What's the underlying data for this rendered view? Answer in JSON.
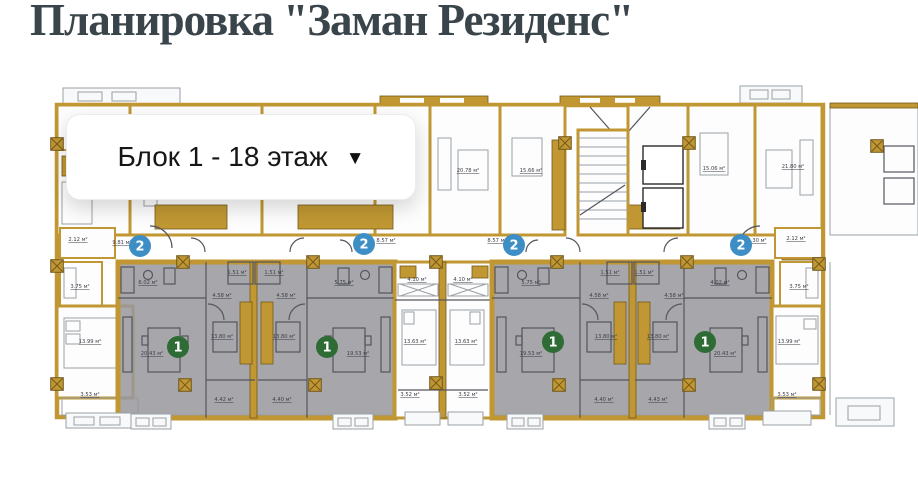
{
  "header": {
    "title": "Планировка \"Заман Резиденс\""
  },
  "selector": {
    "value": "Блок 1 - 18 этаж",
    "icon": "chevron-down"
  },
  "colors": {
    "wall": "#c09733",
    "wall_dark": "#73591b",
    "unit_highlight": "#96969c",
    "badge_green": "#2e6b35",
    "badge_blue": "#3e8ec6",
    "title": "#3a444b",
    "line": "#9aa1a6",
    "dark_line": "#55555e"
  },
  "plan": {
    "area_unit": "м²",
    "badges": [
      {
        "name": "rooms-2-badge",
        "label": "2",
        "x": 140,
        "y": 246,
        "color": "#3e8ec6"
      },
      {
        "name": "rooms-2-badge",
        "label": "2",
        "x": 364,
        "y": 244,
        "color": "#3e8ec6"
      },
      {
        "name": "rooms-2-badge",
        "label": "2",
        "x": 514,
        "y": 245,
        "color": "#3e8ec6"
      },
      {
        "name": "rooms-2-badge",
        "label": "2",
        "x": 741,
        "y": 245,
        "color": "#3e8ec6"
      },
      {
        "name": "rooms-1-badge",
        "label": "1",
        "x": 178,
        "y": 347,
        "color": "#2e6b35"
      },
      {
        "name": "rooms-1-badge",
        "label": "1",
        "x": 327,
        "y": 347,
        "color": "#2e6b35"
      },
      {
        "name": "rooms-1-badge",
        "label": "1",
        "x": 553,
        "y": 342,
        "color": "#2e6b35"
      },
      {
        "name": "rooms-1-badge",
        "label": "1",
        "x": 705,
        "y": 342,
        "color": "#2e6b35"
      }
    ],
    "area_labels": [
      {
        "text": "2.12 м²",
        "x": 78,
        "y": 241
      },
      {
        "text": "9.81 м²",
        "x": 122,
        "y": 244
      },
      {
        "text": "3.75 м²",
        "x": 80,
        "y": 288
      },
      {
        "text": "13.99 м²",
        "x": 90,
        "y": 343
      },
      {
        "text": "3.53 м²",
        "x": 90,
        "y": 396
      },
      {
        "text": "6.02 м²",
        "x": 148,
        "y": 284
      },
      {
        "text": "1.51 м²",
        "x": 237,
        "y": 274
      },
      {
        "text": "4.58 м²",
        "x": 222,
        "y": 297
      },
      {
        "text": "20.43 м²",
        "x": 152,
        "y": 355
      },
      {
        "text": "13.80 м²",
        "x": 222,
        "y": 338
      },
      {
        "text": "4.42 м²",
        "x": 224,
        "y": 401
      },
      {
        "text": "1.51 м²",
        "x": 274,
        "y": 274
      },
      {
        "text": "4.58 м²",
        "x": 286,
        "y": 297
      },
      {
        "text": "13.80 м²",
        "x": 284,
        "y": 338
      },
      {
        "text": "5.75 м²",
        "x": 344,
        "y": 284
      },
      {
        "text": "19.53 м²",
        "x": 358,
        "y": 355
      },
      {
        "text": "4.40 м²",
        "x": 282,
        "y": 401
      },
      {
        "text": "8.57 м²",
        "x": 386,
        "y": 242
      },
      {
        "text": "8.57 м²",
        "x": 497,
        "y": 242
      },
      {
        "text": "4.10 м²",
        "x": 417,
        "y": 281
      },
      {
        "text": "4.10 м²",
        "x": 463,
        "y": 281
      },
      {
        "text": "13.63 м²",
        "x": 415,
        "y": 343
      },
      {
        "text": "13.63 м²",
        "x": 466,
        "y": 343
      },
      {
        "text": "3.52 м²",
        "x": 410,
        "y": 396
      },
      {
        "text": "3.52 м²",
        "x": 468,
        "y": 396
      },
      {
        "text": "20.78 м²",
        "x": 468,
        "y": 172
      },
      {
        "text": "15.66 м²",
        "x": 531,
        "y": 172
      },
      {
        "text": "15.06 м²",
        "x": 714,
        "y": 170
      },
      {
        "text": "21.80 м²",
        "x": 793,
        "y": 168
      },
      {
        "text": "5.75 м²",
        "x": 531,
        "y": 284
      },
      {
        "text": "4.58 м²",
        "x": 599,
        "y": 297
      },
      {
        "text": "1.51 м²",
        "x": 610,
        "y": 274
      },
      {
        "text": "19.53 м²",
        "x": 531,
        "y": 355
      },
      {
        "text": "13.80 м²",
        "x": 606,
        "y": 338
      },
      {
        "text": "4.40 м²",
        "x": 604,
        "y": 401
      },
      {
        "text": "1.51 м²",
        "x": 644,
        "y": 274
      },
      {
        "text": "4.58 м²",
        "x": 674,
        "y": 297
      },
      {
        "text": "13.80 м²",
        "x": 658,
        "y": 338
      },
      {
        "text": "4.02 м²",
        "x": 720,
        "y": 284
      },
      {
        "text": "20.43 м²",
        "x": 725,
        "y": 355
      },
      {
        "text": "4.43 м²",
        "x": 658,
        "y": 401
      },
      {
        "text": "5.30 м²",
        "x": 757,
        "y": 242
      },
      {
        "text": "2.12 м²",
        "x": 796,
        "y": 240
      },
      {
        "text": "3.75 м²",
        "x": 799,
        "y": 288
      },
      {
        "text": "13.99 м²",
        "x": 789,
        "y": 343
      },
      {
        "text": "3.53 м²",
        "x": 787,
        "y": 396
      }
    ]
  }
}
